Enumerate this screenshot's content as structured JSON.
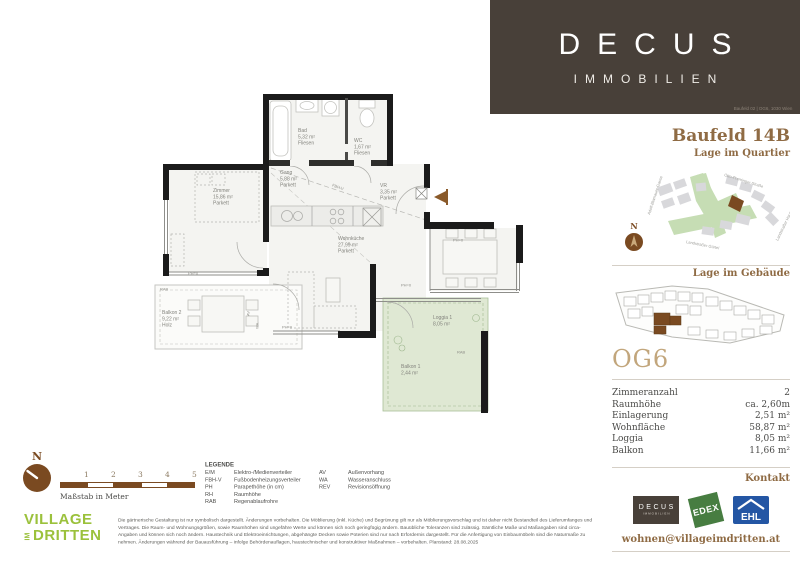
{
  "header": {
    "brand": "DECUS",
    "brand_sub": "IMMOBILIEN",
    "address": "Baufeld 02 | OG6, 1030 Wien"
  },
  "sidebar": {
    "title": "Baufeld 14B",
    "section_quartier": "Lage im Quartier",
    "section_gebaeude": "Lage im Gebäude",
    "unit": "OG6",
    "north": "N",
    "details": [
      {
        "label": "Zimmeranzahl",
        "value": "2"
      },
      {
        "label": "Raumhöhe",
        "value": "ca. 2,60m"
      },
      {
        "label": "Einlagerung",
        "value": "2,51 m²"
      },
      {
        "label": "Wohnfläche",
        "value": "58,87 m²"
      },
      {
        "label": "Loggia",
        "value": "8,05 m²"
      },
      {
        "label": "Balkon",
        "value": "11,66 m²"
      }
    ],
    "kontakt": "Kontakt",
    "email": "wohnen@villageimdritten.at",
    "logo_edex": "EDEX",
    "logo_ehl": "EHL"
  },
  "map": {
    "streets": [
      "Otto-Preminger-Straße",
      "Adolf-Blamauer-Gasse",
      "Landstraßer Gürtel",
      "Landstraßer Hauptstraße"
    ]
  },
  "plan": {
    "rooms": [
      {
        "name": "Bad",
        "area": "5,32 m²",
        "floor": "Fliesen"
      },
      {
        "name": "WC",
        "area": "1,67 m²",
        "floor": "Fliesen"
      },
      {
        "name": "Gang",
        "area": "5,88 m²",
        "floor": "Parkett"
      },
      {
        "name": "VR",
        "area": "3,35 m²",
        "floor": "Parkett"
      },
      {
        "name": "Zimmer",
        "area": "15,86 m²",
        "floor": "Parkett"
      },
      {
        "name": "Wohnküche",
        "area": "27,99 m²",
        "floor": "Parkett"
      },
      {
        "name": "Balkon 2",
        "area": "9,22 m²",
        "floor": "Holz"
      },
      {
        "name": "Loggia 1",
        "area": "8,05 m²",
        "floor": ""
      },
      {
        "name": "Balkon 1",
        "area": "2,44 m²",
        "floor": ""
      }
    ],
    "ann": {
      "ph": "PH=0",
      "rab": "RAB",
      "av": "AV",
      "wa": "WA",
      "fbhv": "FBH-V"
    }
  },
  "footer": {
    "north": "N",
    "scale_ticks": [
      "1",
      "2",
      "3",
      "4",
      "5"
    ],
    "scale_caption": "Maßstab in Meter",
    "village": {
      "line1": "VILLAGE",
      "im": "IM",
      "line2": "DRITTEN"
    },
    "legend_title": "LEGENDE",
    "legend_col1": [
      {
        "a": "E/M",
        "t": "Elektro-/Medienverteiler"
      },
      {
        "a": "FBH-V",
        "t": "Fußbodenheizungsverteiler"
      },
      {
        "a": "PH",
        "t": "Parapethöhe (in cm)"
      },
      {
        "a": "RH",
        "t": "Raumhöhe"
      },
      {
        "a": "RAB",
        "t": "Regenablaufrohre"
      }
    ],
    "legend_col2": [
      {
        "a": "AV",
        "t": "Außenvorhang"
      },
      {
        "a": "WA",
        "t": "Wasseranschluss"
      },
      {
        "a": "REV",
        "t": "Revisionsöffnung"
      }
    ],
    "disclaimer": "Die gärtnerische Gestaltung ist nur symbolisch dargestellt. Änderungen vorbehalten. Die Möblierung (inkl. Küche) und Begrünung gilt nur als Möblierungsvorschlag und ist daher nicht Bestandteil des Lieferumfanges und Vertrages. Die Raum- und Wohnungsgrößen, sowie Raumhöhen sind ungefähre Werte und können sich noch geringfügig ändern. Bauübliche Toleranzen sind zulässig. Sämtliche Maße und Maßangaben sind circa-Angaben und können sich noch ändern. Haustechnik und Elektroeinrichtungen, abgehängte Decken sowie Poterien sind nur nach Erfordernis dargestellt. Für die Anfertigung von Einbaumöbeln sind die Naturmaße zu nehmen. Änderungen während der Bauausführung – infolge Behördenauflagen, haustechnischer und konstruktiver Maßnahmen – vorbehalten. Planstand: 28.08.2025",
    "project_label": "EIN PROJEKT DER",
    "project_brand": "ARE",
    "project_sub": "Austrian Real Estate"
  }
}
